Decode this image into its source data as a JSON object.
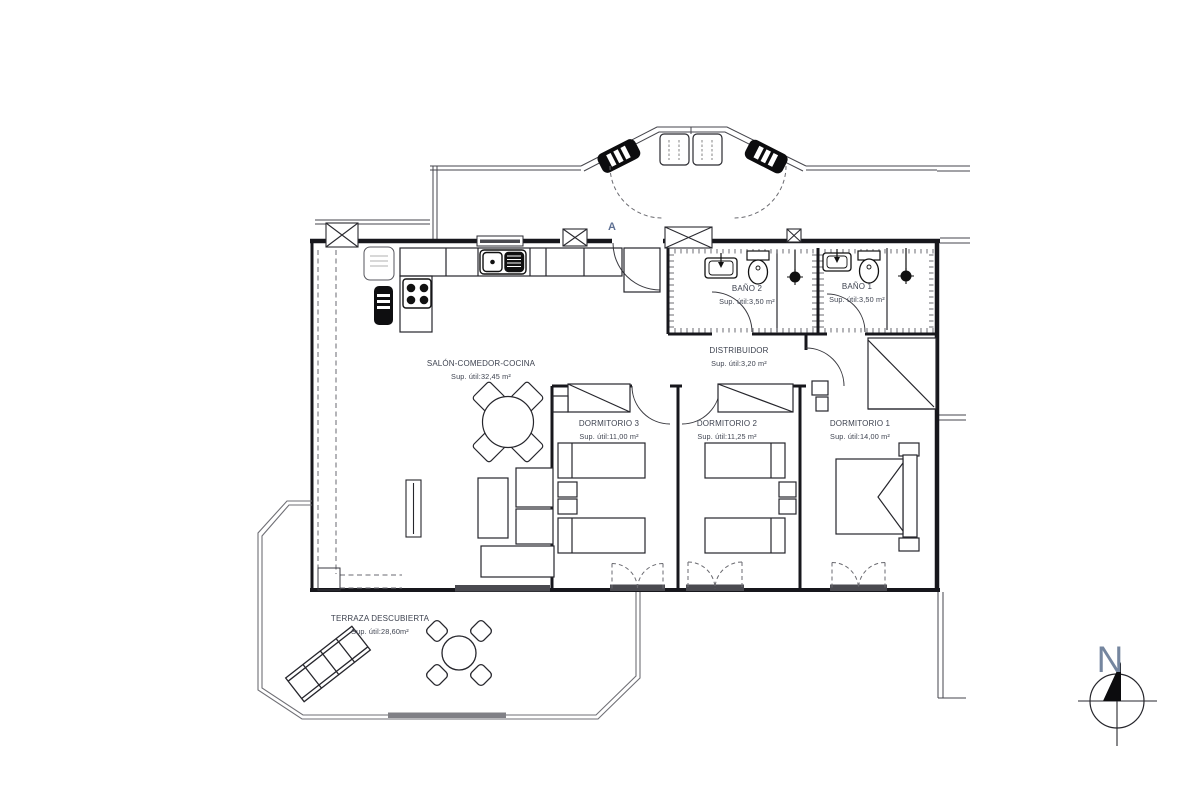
{
  "rooms": [
    {
      "id": "salon-comedor-cocina",
      "name": "SALÓN-COMEDOR-COCINA",
      "area": "Sup. útil:32,45 m²"
    },
    {
      "id": "dormitorio-3",
      "name": "DORMITORIO 3",
      "area": "Sup. útil:11,00 m²"
    },
    {
      "id": "dormitorio-2",
      "name": "DORMITORIO 2",
      "area": "Sup. útil:11,25 m²"
    },
    {
      "id": "dormitorio-1",
      "name": "DORMITORIO 1",
      "area": "Sup. útil:14,00 m²"
    },
    {
      "id": "bano-2",
      "name": "BAÑO 2",
      "area": "Sup. útil:3,50 m²"
    },
    {
      "id": "bano-1",
      "name": "BAÑO 1",
      "area": "Sup. útil:3,50 m²"
    },
    {
      "id": "distribuidor",
      "name": "DISTRIBUIDOR",
      "area": "Sup. útil:3,20 m²"
    },
    {
      "id": "terraza-descubierta",
      "name": "TERRAZA DESCUBIERTA",
      "area": "Sup. útil:28,60m²"
    }
  ],
  "markers": {
    "section_label": "A",
    "north_label": "N"
  },
  "colors": {
    "line": "#17171c",
    "label_text": "#3e4350",
    "marker_blue": "#5e7093",
    "north_blue": "#75869f"
  }
}
